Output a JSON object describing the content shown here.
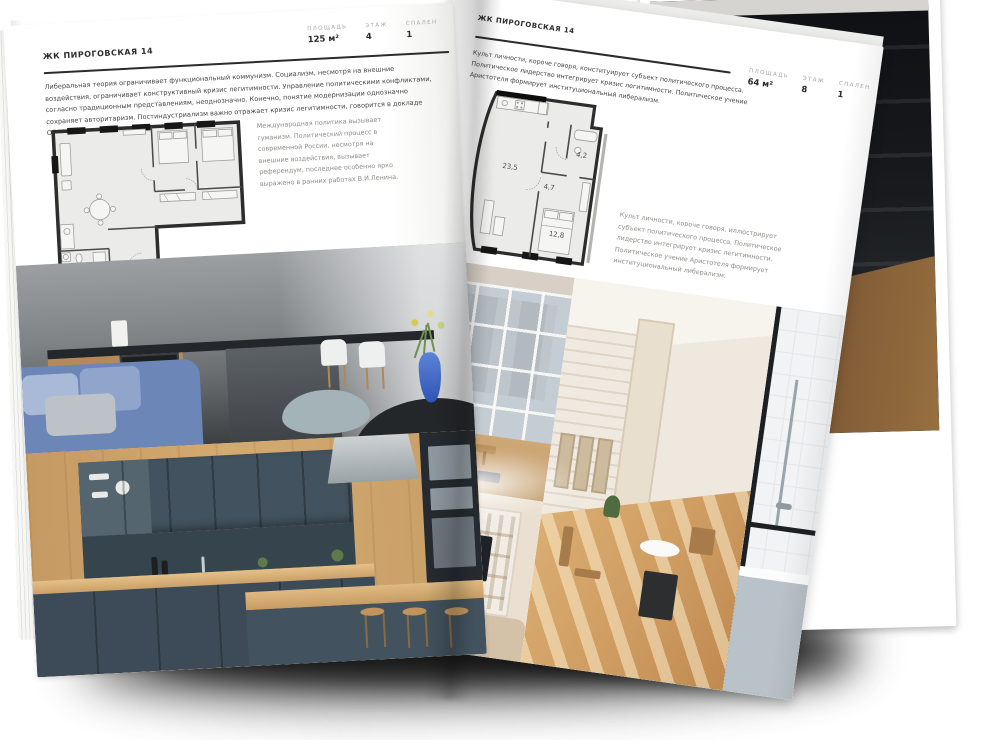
{
  "scene": {
    "background": "#ffffff",
    "page_color": "#ffffff",
    "rule_color": "#2b2b2b",
    "shadow_color": "#000000"
  },
  "left_page": {
    "title": "ЖК ПИРОГОВСКАЯ 14",
    "stats": [
      {
        "label": "ПЛОЩАДЬ",
        "value": "125 м²"
      },
      {
        "label": "ЭТАЖ",
        "value": "4"
      },
      {
        "label": "СПАЛЕН",
        "value": "1"
      }
    ],
    "intro": "Либеральная теория ограничивает функциональный коммунизм. Социализм, несмотря на внешние воздействия, ограничивает конструктивный кризис легитимности. Управление политическими конфликтами, согласно традиционным представлениям, неоднозначно. Конечно, понятие модернизации однозначно сохраняет авторитаризм. Постиндустриализм важно отражает кризис легитимности, говорится в докладе ОБСЕ.",
    "caption": "Международная политика вызывает гуманизм. Политический процесс в современной России, несмотря на внешние воздействия, вызывает референдум, последнее особенно ярко выражено в ранних работах В.И.Ленина.",
    "photos": [
      {
        "name": "dark-kitchen-photo",
        "summary": "graphite kitchen, white chairs, blue sofa, blue vase with flowers"
      },
      {
        "name": "slate-oak-kitchen-photo",
        "summary": "slate blue cabinets with oak worktop and bar stools"
      }
    ]
  },
  "right_page": {
    "title": "ЖК ПИРОГОВСКАЯ 14",
    "stats": [
      {
        "label": "ПЛОЩАДЬ",
        "value": "64 м²"
      },
      {
        "label": "ЭТАЖ",
        "value": "8"
      },
      {
        "label": "СПАЛЕН",
        "value": "1"
      }
    ],
    "intro": "Культ личности, короче говоря, конституирует субъект политического процесса. Политическое лидерство интегрирует кризис легитимности. Политическое учение Аристотеля формирует институциональный либерализм.",
    "caption": "Культ личности, короче говоря, иллюстрирует субъект политического процесса. Политическое лидерство интегрирует кризис легитимности. Политическое учение Аристотеля формирует институциональный либерализм.",
    "plan_rooms": {
      "living": "23,5",
      "hall": "4,7",
      "bathroom": "4,2",
      "bedroom": "12,8"
    },
    "photos": [
      {
        "name": "window-wall-photo",
        "summary": "loft window wall with city view and wooden bench"
      },
      {
        "name": "tv-shelf-room-photo",
        "summary": "beige living room with shelving and TV"
      },
      {
        "name": "sunlit-room-photo",
        "summary": "sunlit room, white brick, wooden chairs"
      },
      {
        "name": "bathroom-photo",
        "summary": "white tiled bathroom with black-framed glass"
      }
    ]
  }
}
